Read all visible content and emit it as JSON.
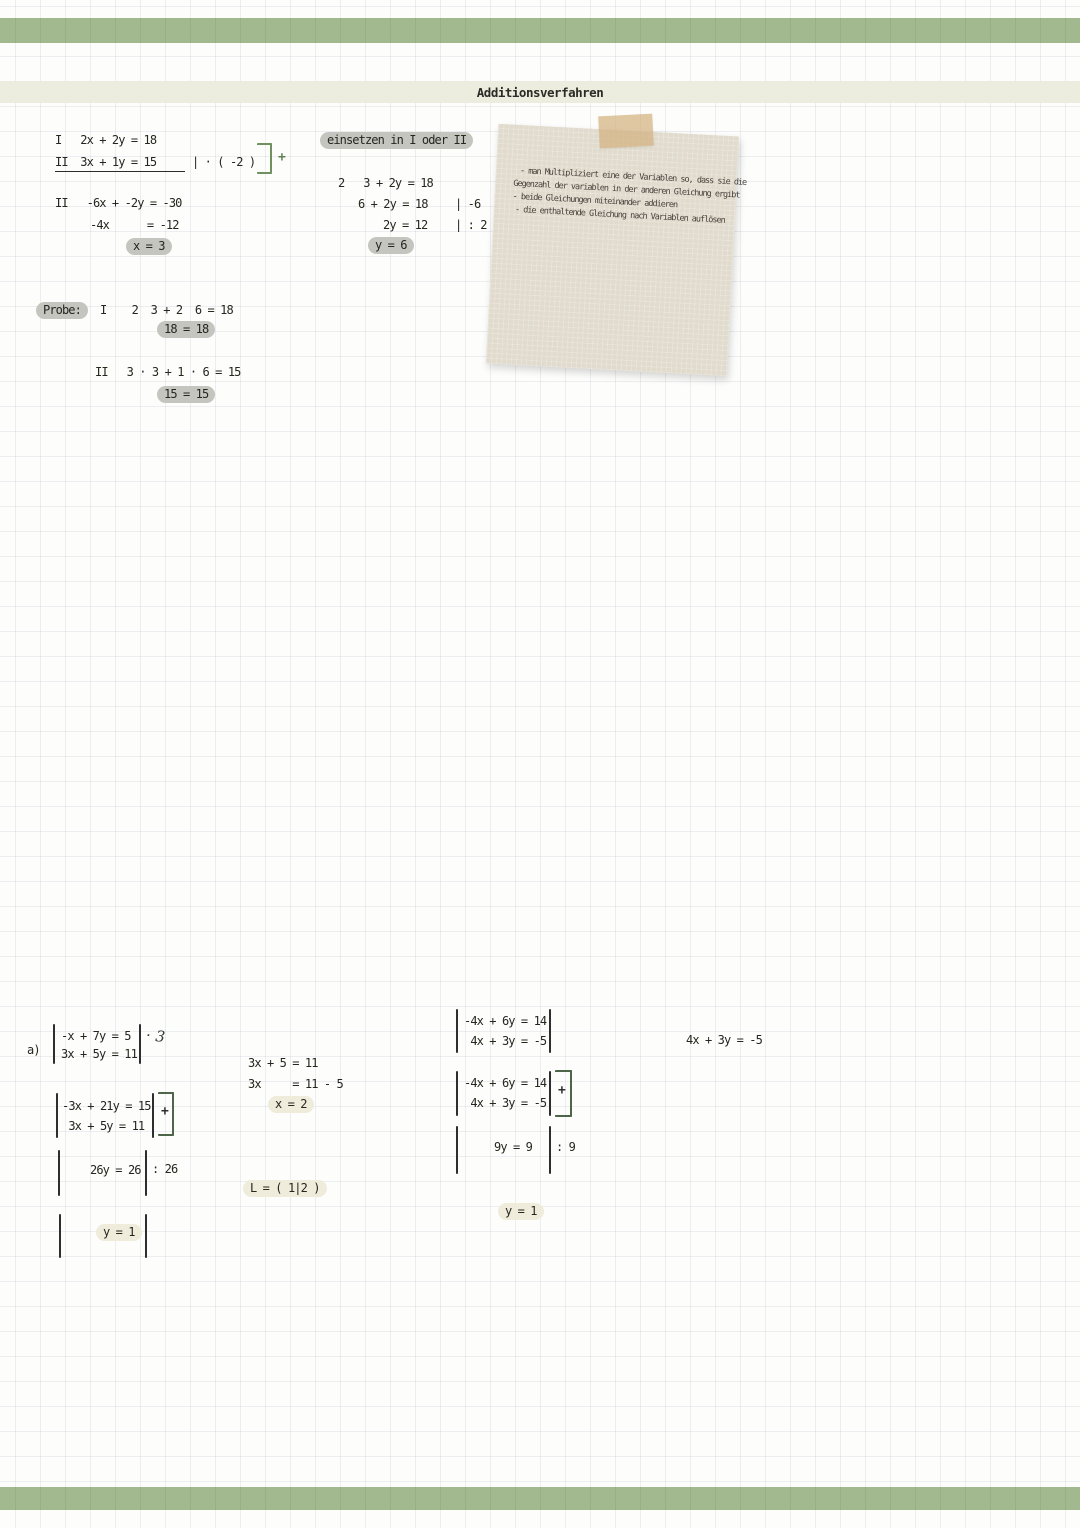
{
  "page": {
    "title": "Additionsverfahren",
    "colors": {
      "banner_green": "#a2b990",
      "title_band": "#ececdd",
      "pill_gray": "#c5c5c0",
      "pill_cream": "#efecdb",
      "accent_green": "#5f8152",
      "note_bg": "#e1dbcd",
      "tape": "#d3b280"
    }
  },
  "example": {
    "eq1": "I   2x + 2y = 18",
    "eq2": "II  3x + 1y = 15",
    "eq2_op": "| · ( -2 )",
    "plus": "+",
    "eq3": "II   -6x + -2y = -30",
    "eq4": "-4x      = -12",
    "result_x": "x = 3",
    "insert_label": "einsetzen in I oder II",
    "sub1": "2   3 + 2y = 18",
    "sub2": "6 + 2y = 18",
    "sub2_op": "| -6",
    "sub3": "2y = 12",
    "sub3_op": "| : 2",
    "result_y": "y = 6"
  },
  "probe": {
    "label": "Probe:",
    "line1": "I    2  3 + 2  6 = 18",
    "result1": "18 = 18",
    "line2": "II   3 · 3 + 1 · 6 = 15",
    "result2": "15 = 15"
  },
  "note": {
    "line1": "- man Multipliziert eine der Variablen so, dass sie die",
    "line2": "Gegenzahl der variablen in der anderen Gleichung ergibt",
    "line3": "- beide Gleichungen miteinander addieren",
    "line4": "- die enthaltende Gleichung nach Variablen auflösen"
  },
  "exercise_a": {
    "label": "a)",
    "sys1_row1": "-x + 7y = 5",
    "sys1_row2": "3x + 5y = 11",
    "sys1_op": "· 3",
    "sys2_row1": "-3x + 21y = 15",
    "sys2_row2": " 3x + 5y = 11",
    "plus": "+",
    "step1": "26y = 26",
    "step1_op": ": 26",
    "result_y": "y = 1",
    "sub1": "3x + 5 = 11",
    "sub2": "3x     = 11 - 5",
    "result_x": "x = 2",
    "solution": "L = ( 1|2 )"
  },
  "exercise_b": {
    "sys1_row1": "-4x + 6y = 14",
    "sys1_row2": " 4x + 3y = -5",
    "sys2_row1": "-4x + 6y = 14",
    "sys2_row2": " 4x + 3y = -5",
    "plus": "+",
    "step1": "9y = 9",
    "step1_op": ": 9",
    "result_y": "y = 1",
    "side_eq": "4x + 3y = -5"
  }
}
